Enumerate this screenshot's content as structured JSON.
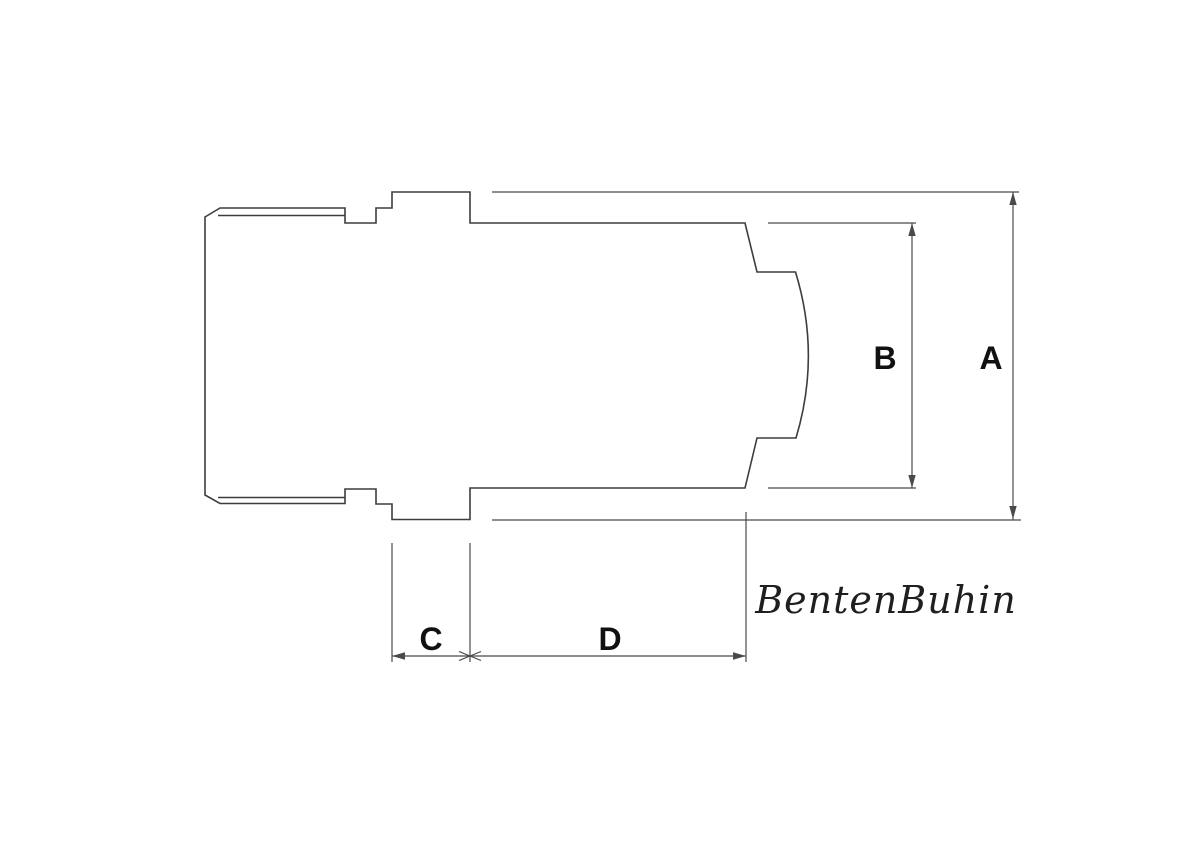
{
  "diagram": {
    "labels": {
      "dim_a": "A",
      "dim_b": "B",
      "dim_c": "C",
      "dim_d": "D"
    },
    "watermark": "BentenBuhin",
    "colors": {
      "line": "#3d3d3d",
      "dimension_line": "#4a4a4a",
      "label_text": "#111111",
      "watermark_text": "#1f1f1f",
      "background": "#ffffff"
    }
  }
}
